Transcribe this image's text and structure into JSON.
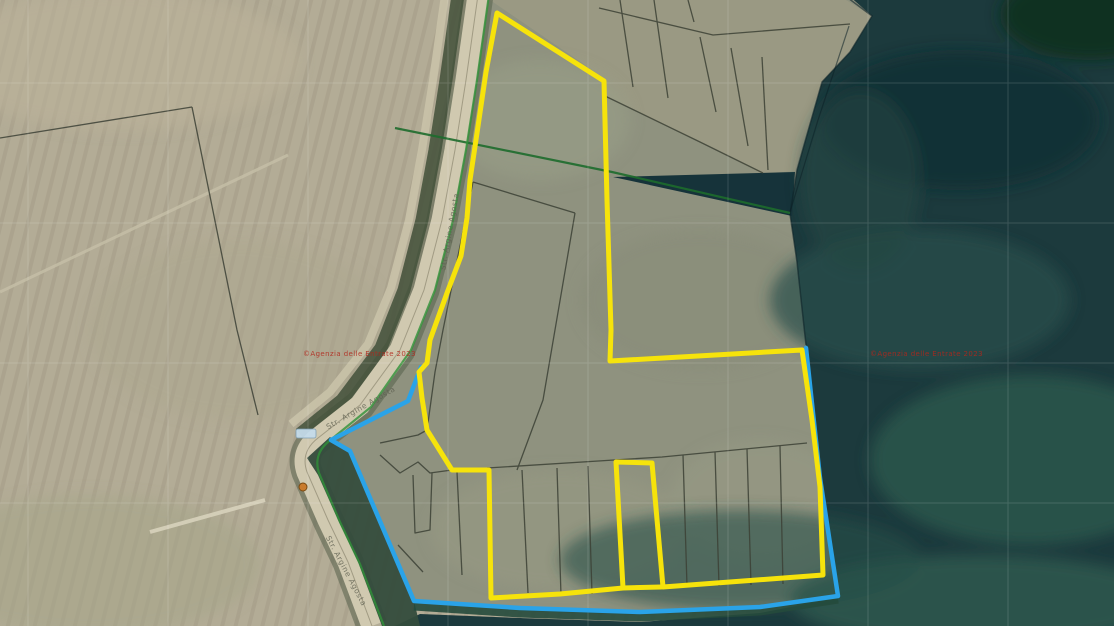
{
  "map": {
    "watermark_left": {
      "text": "©Agenzia delle Entrate 2023"
    },
    "watermark_right": {
      "text": "©Agenzia delle Entrate 2023"
    },
    "road_labels": [
      {
        "text": "Str. Argine Agosta"
      },
      {
        "text": "Str. Argine Agosta"
      },
      {
        "text": "Str. Argine Agosta"
      }
    ],
    "colors": {
      "selection_yellow": "#f6e30b",
      "selection_blue": "#2aa3e8",
      "boundary_green": "#2f9138",
      "boundary_green_dark": "#1d6b2c",
      "watermark_red": "#b2271c",
      "water_teal": "#1c3a3d",
      "field_beige": "#b3ac96",
      "polder_gray_green": "#8f927f",
      "road_light": "#d0c9b0",
      "marker_orange": "#c97b2d"
    }
  }
}
